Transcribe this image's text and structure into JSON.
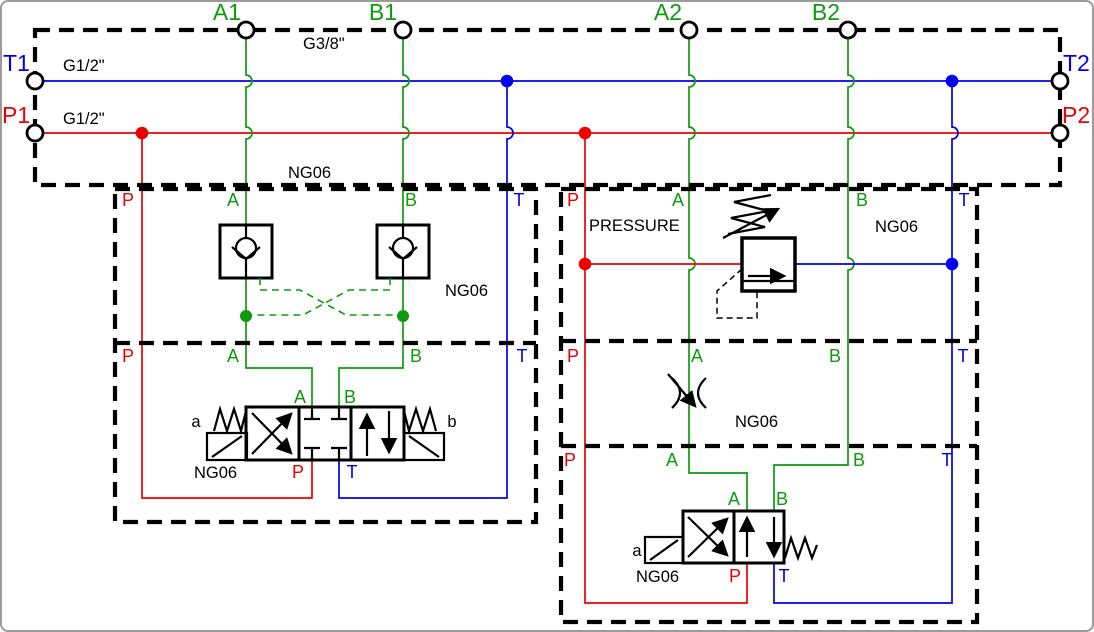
{
  "colors": {
    "pressure_line": "#ec0000",
    "tank_line": "#0000ea",
    "work_line": "#0d9b0d",
    "outline": "#000000"
  },
  "manifold": {
    "top_ports": [
      "A1",
      "B1",
      "A2",
      "B2"
    ],
    "side_ports": {
      "t1": "T1",
      "p1": "P1",
      "t2": "T2",
      "p2": "P2"
    },
    "top_thread": "G3/8\"",
    "t_thread": "G1/2\"",
    "p_thread": "G1/2\"",
    "size": "NG06"
  },
  "station1": {
    "check_module": {
      "p": "P",
      "a": "A",
      "b": "B",
      "t": "T",
      "size": "NG06"
    },
    "valve_module": {
      "p": "P",
      "a": "A",
      "b": "B",
      "t": "T",
      "valve": {
        "port_a": "A",
        "port_b": "B",
        "port_p": "P",
        "port_t": "T",
        "sol_a": "a",
        "sol_b": "b",
        "size": "NG06"
      }
    }
  },
  "station2": {
    "pressure_module": {
      "p": "P",
      "a": "A",
      "b": "B",
      "t": "T",
      "label": "PRESSURE",
      "size": "NG06"
    },
    "flow_module": {
      "p": "P",
      "a": "A",
      "b": "B",
      "t": "T",
      "size": "NG06"
    },
    "valve_module": {
      "p": "P",
      "a": "A",
      "b": "B",
      "t": "T",
      "valve": {
        "port_a": "A",
        "port_b": "B",
        "port_p": "P",
        "port_t": "T",
        "sol_a": "a",
        "size": "NG06"
      }
    }
  }
}
